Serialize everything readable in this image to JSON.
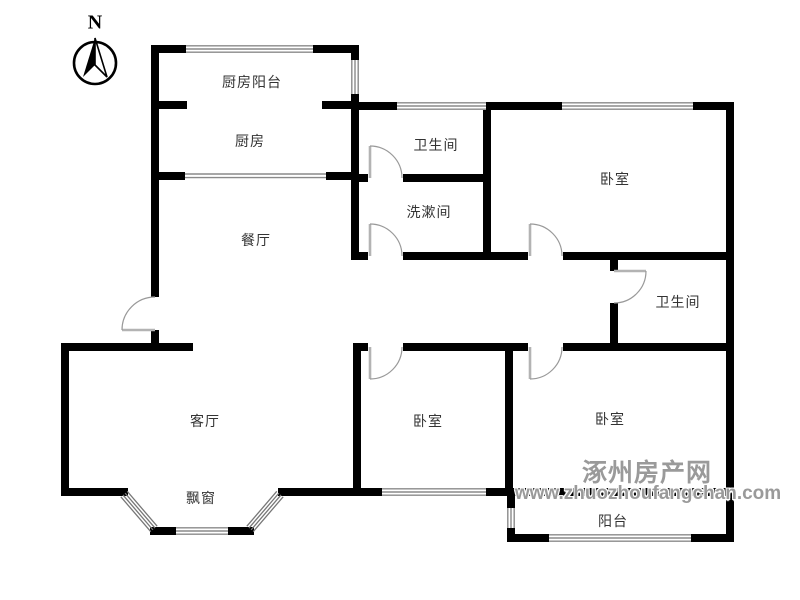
{
  "compass": {
    "label": "N"
  },
  "rooms": {
    "kitchen_balcony": "厨房阳台",
    "kitchen": "厨房",
    "bathroom_top": "卫生间",
    "washroom": "洗漱间",
    "dining": "餐厅",
    "bedroom_northeast": "卧室",
    "bathroom_east": "卫生间",
    "living_room": "客厅",
    "bedroom_south": "卧室",
    "bedroom_southeast": "卧室",
    "bay_window": "飘窗",
    "balcony": "阳台"
  },
  "watermark": {
    "site_name": "涿州房产网",
    "site_url": "www.zhuozhoufangchan.com"
  },
  "colors": {
    "wall": "#000000",
    "door_leaf": "#b3b3b3",
    "door_arc": "#999999",
    "window_line": "#8a8a8a",
    "label_text": "#333333",
    "watermark_gray": "#9a9a9a"
  }
}
